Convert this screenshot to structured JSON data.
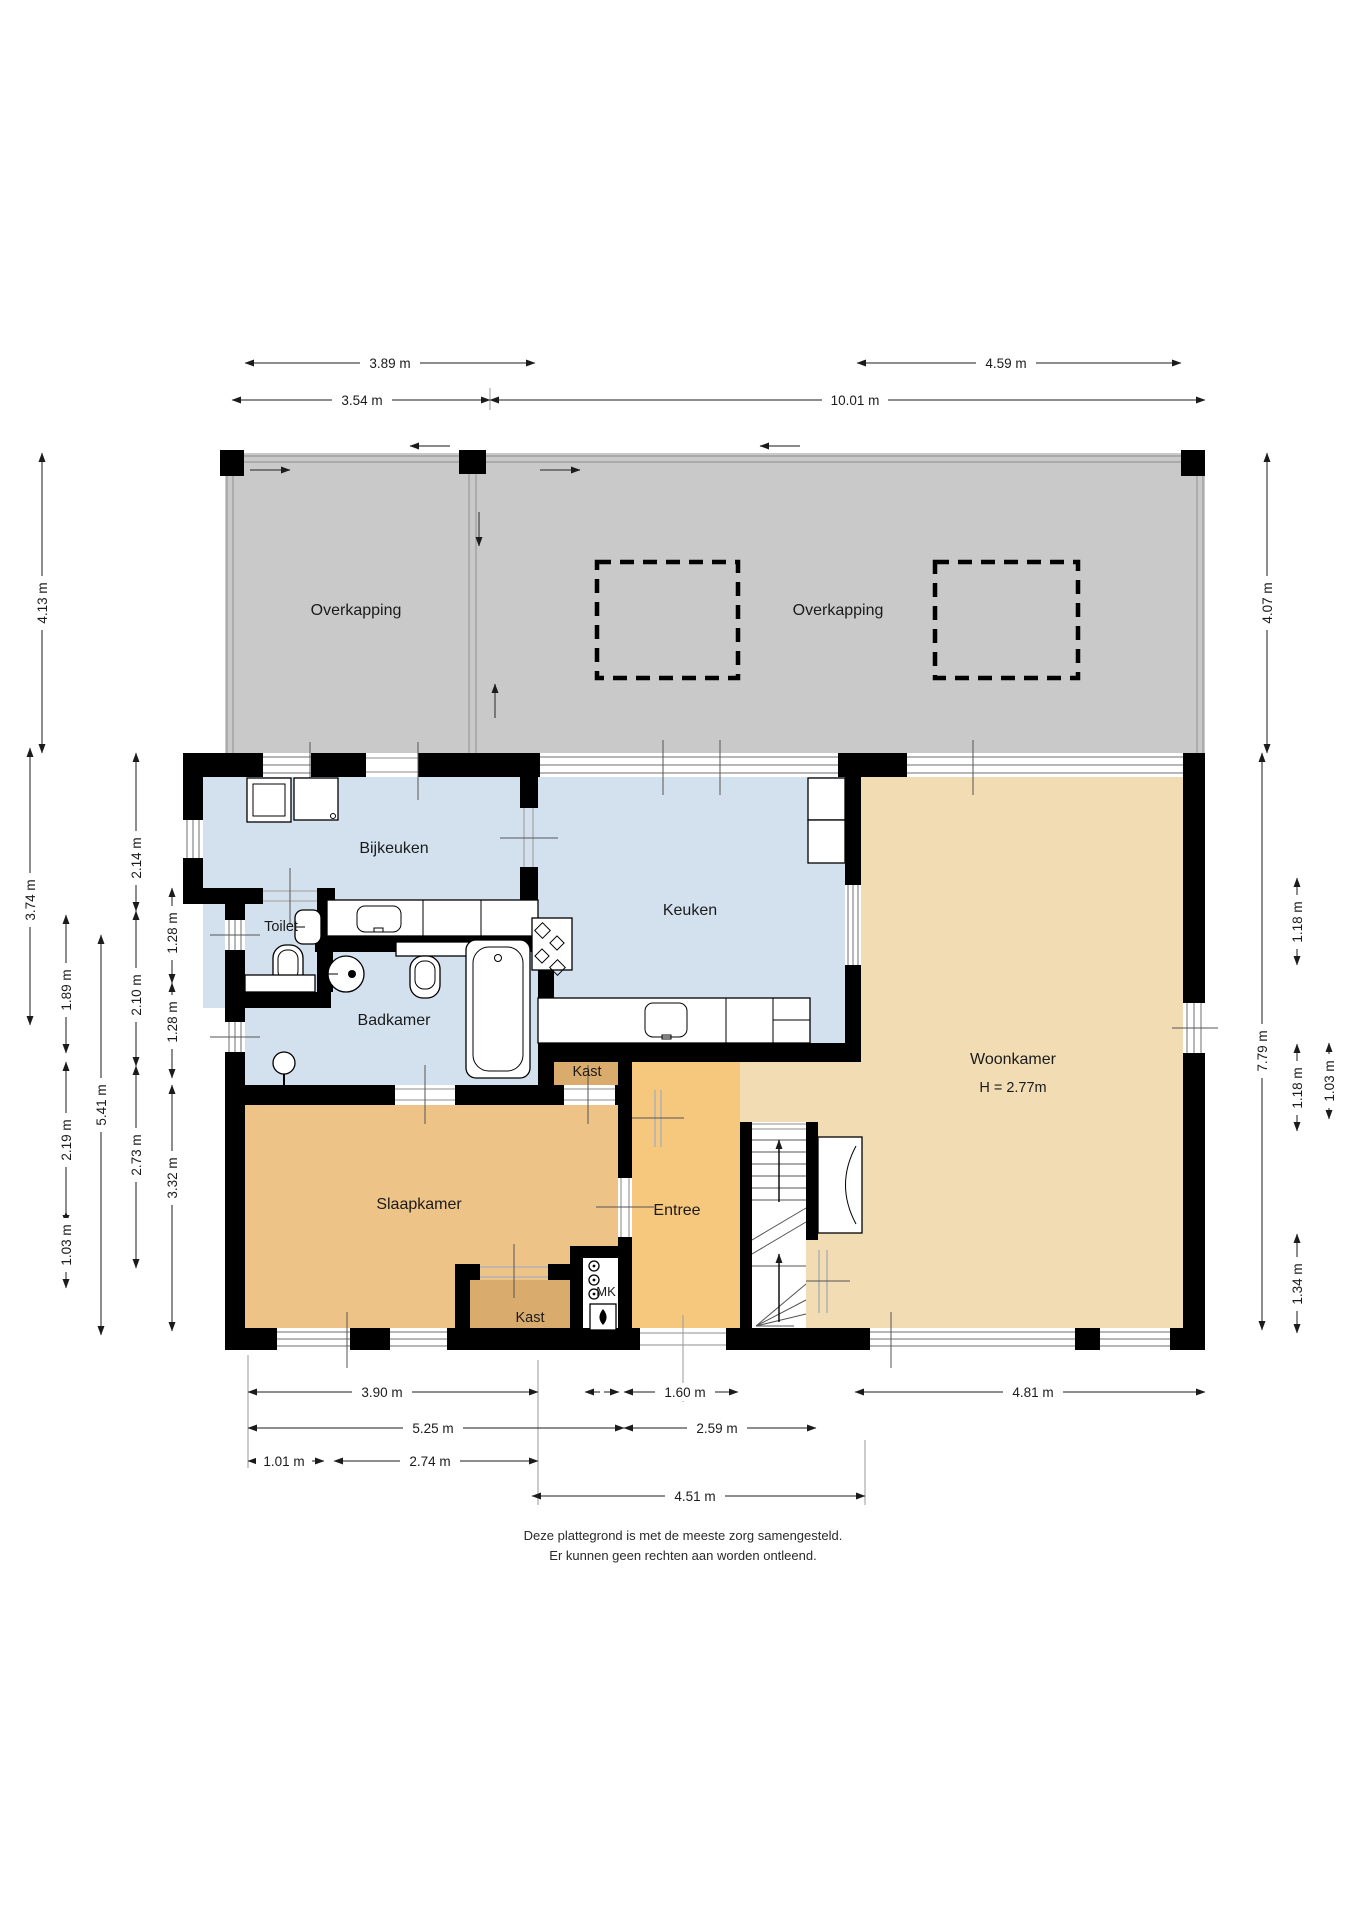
{
  "rooms": {
    "overkapping_left": {
      "label": "Overkapping"
    },
    "overkapping_right": {
      "label": "Overkapping"
    },
    "bijkeuken": {
      "label": "Bijkeuken"
    },
    "toilet": {
      "label": "Toilet"
    },
    "badkamer": {
      "label": "Badkamer"
    },
    "keuken": {
      "label": "Keuken"
    },
    "woonkamer": {
      "label": "Woonkamer",
      "height_note": "H = 2.77m"
    },
    "slaapkamer": {
      "label": "Slaapkamer"
    },
    "entree": {
      "label": "Entree"
    },
    "kast_boven": {
      "label": "Kast"
    },
    "kast_onder": {
      "label": "Kast"
    },
    "mk": {
      "label": "MK"
    }
  },
  "dimensions": {
    "top": [
      "3.89 m",
      "4.59 m",
      "3.54 m",
      "10.01 m"
    ],
    "left": [
      "4.13 m",
      "3.74 m",
      "2.14 m",
      "1.28 m",
      "1.89 m",
      "2.10 m",
      "1.28 m",
      "5.41 m",
      "2.19 m",
      "2.73 m",
      "3.32 m",
      "1.03 m"
    ],
    "right": [
      "4.07 m",
      "1.18 m",
      "7.79 m",
      "1.18 m",
      "1.03 m",
      "1.34 m"
    ],
    "bottom": [
      "3.90 m",
      "1.60 m",
      "4.81 m",
      "5.25 m",
      "2.59 m",
      "1.01 m",
      "2.74 m",
      "4.51 m"
    ]
  },
  "note": {
    "line1": "Deze plattegrond is met de meeste zorg samengesteld.",
    "line2": "Er kunnen geen rechten aan worden ontleend."
  },
  "colors": {
    "overkapping_gray": "#c9c9c9",
    "wet_room_blue": "#d3e1ef",
    "woonkamer_tan": "#f2dcb4",
    "entree_orange": "#f5c87d",
    "slaapkamer_sand": "#edc387",
    "kast_brown": "#d9ab6c",
    "wall_black": "#000000"
  }
}
